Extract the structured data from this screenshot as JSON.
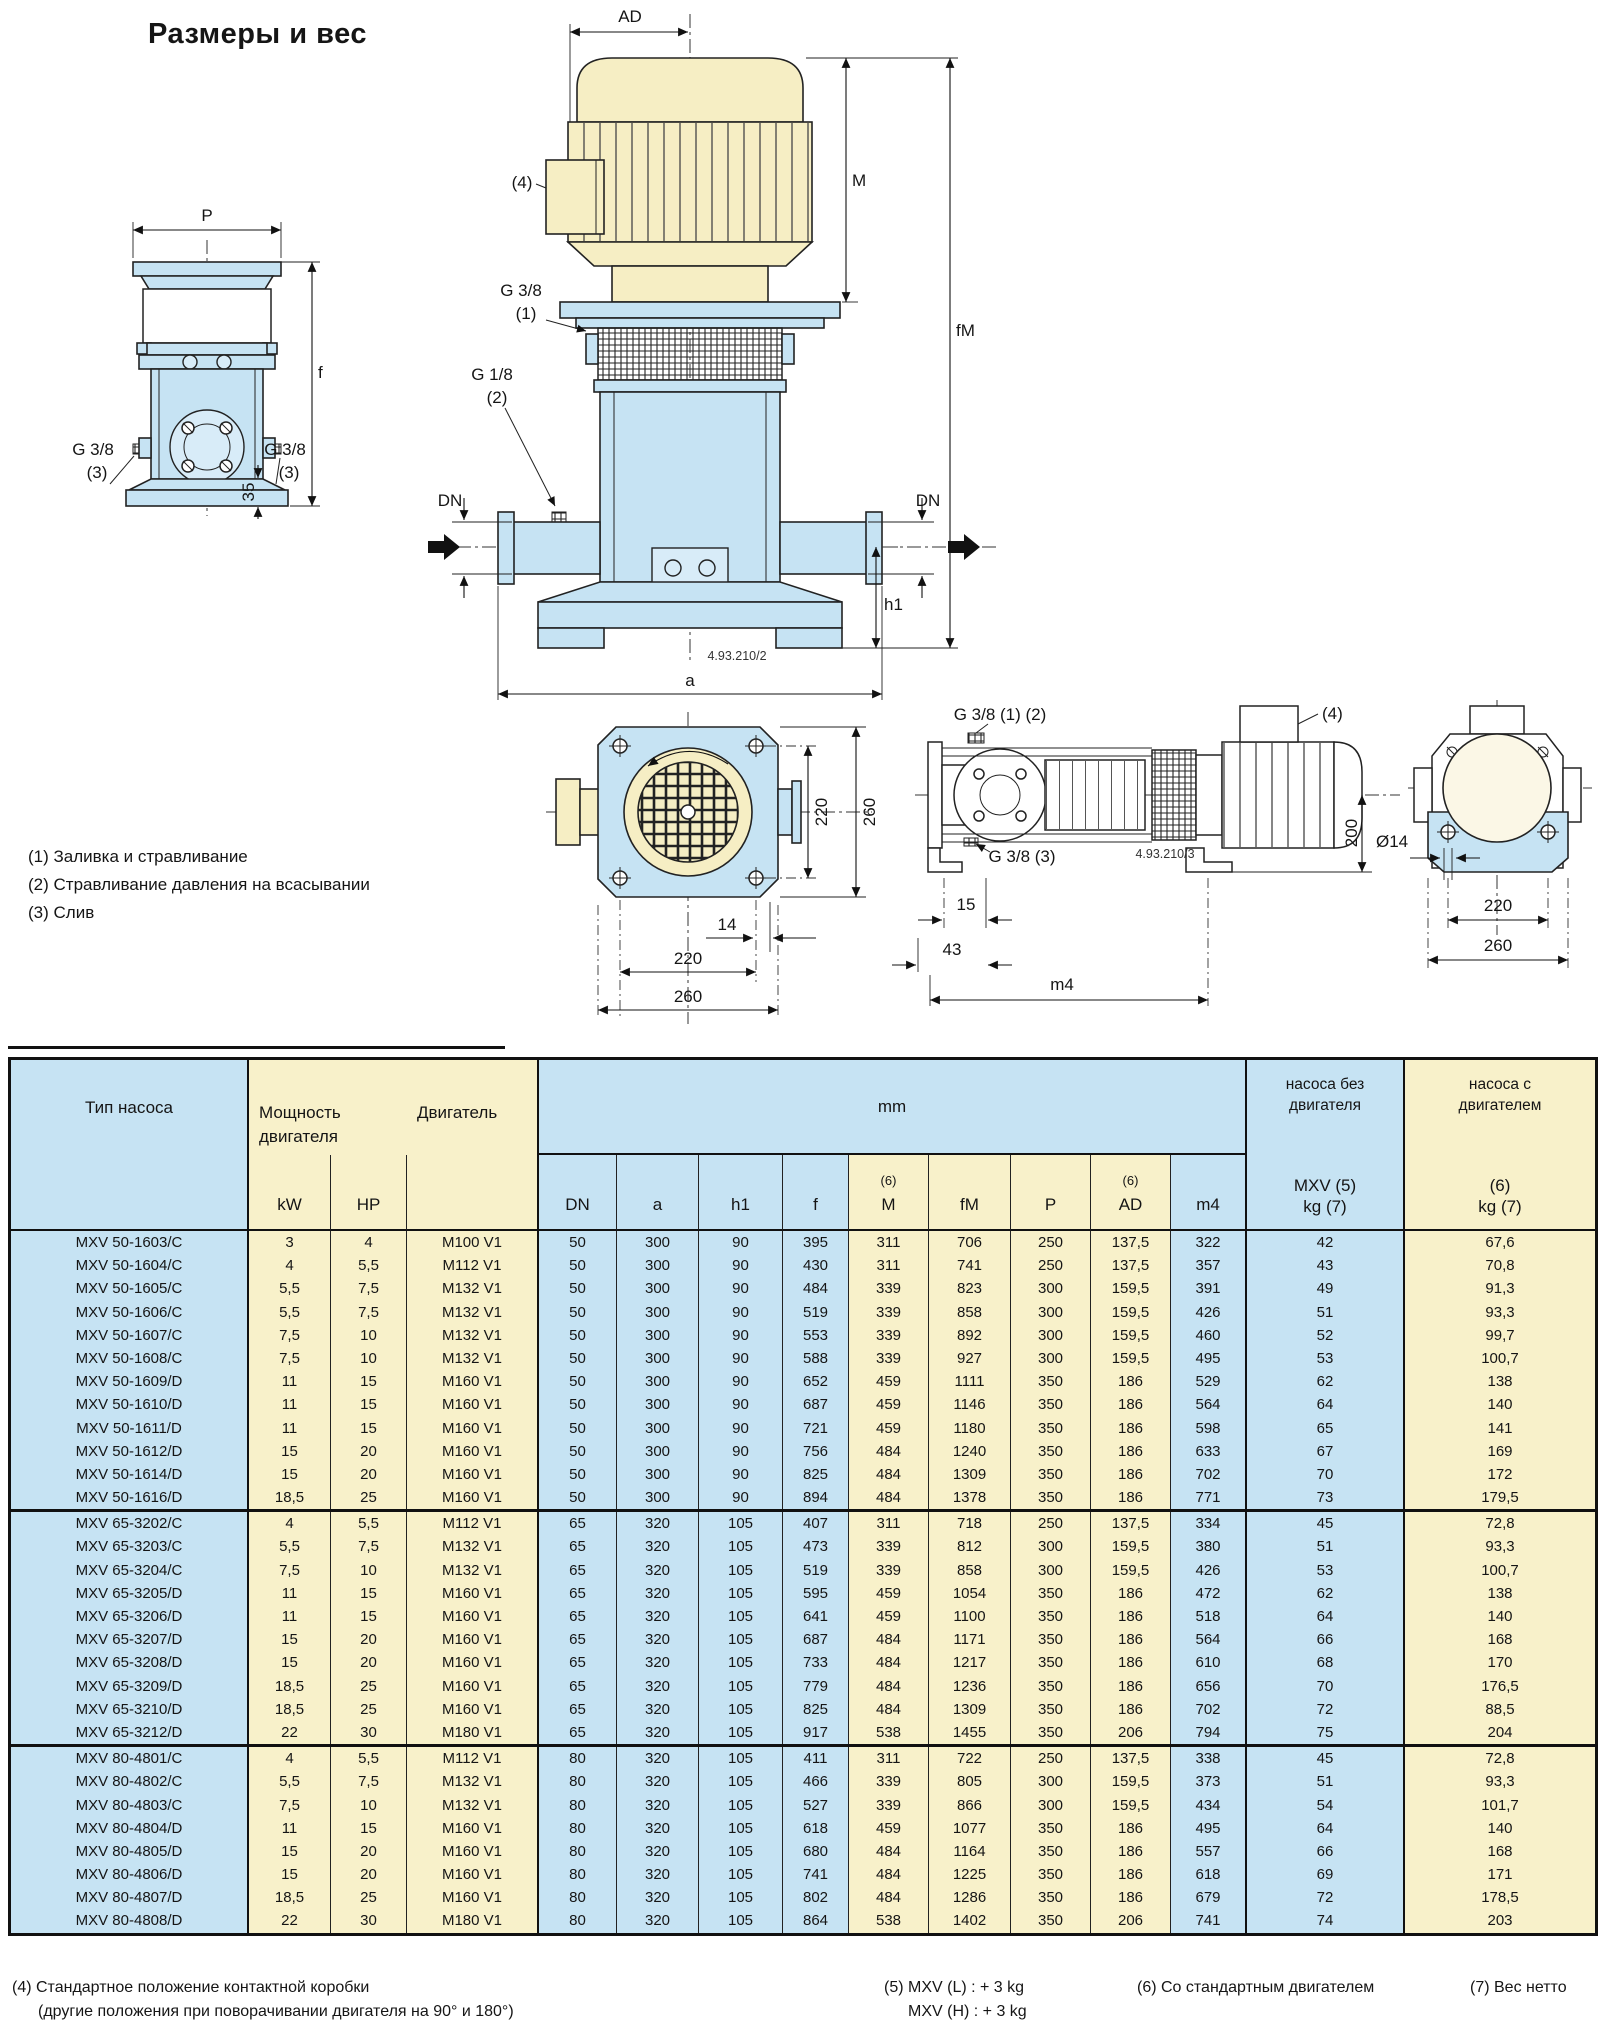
{
  "page": {
    "title": "Размеры и вес"
  },
  "notes": {
    "n1": "(1) Заливка и стравливание",
    "n2": "(2) Стравливание давления на всасывании",
    "n3": "(3) Слив"
  },
  "diagram": {
    "labels": {
      "p": "P",
      "f": "f",
      "g38": "G 3/8",
      "n3": "(3)",
      "d35": "35",
      "ad": "AD",
      "n4": "(4)",
      "m": "M",
      "fm": "fM",
      "n1": "(1)",
      "g18": "G 1/8",
      "n2": "(2)",
      "dn": "DN",
      "h1": "h1",
      "a": "a",
      "dwg2": "4.93.210/2",
      "dwg3": "4.93.210/3",
      "g38_12": "G 3/8 (1) (2)",
      "g38_3": "G 3/8 (3)",
      "d14": "14",
      "d15": "15",
      "d43": "43",
      "m4": "m4",
      "d200": "200",
      "dia14": "Ø14",
      "d220": "220",
      "d260": "260"
    }
  },
  "table": {
    "header": {
      "pump_type": "Тип насоса",
      "power_line1": "Мощность",
      "power_line2": "двигателя",
      "motor": "Двигатель",
      "mm": "mm",
      "kw": "kW",
      "hp": "HP",
      "note6": "(6)",
      "cols": {
        "dn": "DN",
        "a": "a",
        "h1": "h1",
        "f": "f",
        "m": "M",
        "fm": "fM",
        "p": "P",
        "ad": "AD",
        "m4": "m4"
      },
      "wo1": "насоса без",
      "wo2": "двигателя",
      "wo3": "MXV (5)",
      "wo4": "kg (7)",
      "w1": "насоса с",
      "w2": "двигателем",
      "w3": "(6)",
      "w4": "kg (7)"
    },
    "groups": [
      {
        "rows": [
          [
            "MXV 50-1603/C",
            "3",
            "4",
            "M100 V1",
            "50",
            "300",
            "90",
            "395",
            "311",
            "706",
            "250",
            "137,5",
            "322",
            "42",
            "67,6"
          ],
          [
            "MXV 50-1604/C",
            "4",
            "5,5",
            "M112 V1",
            "50",
            "300",
            "90",
            "430",
            "311",
            "741",
            "250",
            "137,5",
            "357",
            "43",
            "70,8"
          ],
          [
            "MXV 50-1605/C",
            "5,5",
            "7,5",
            "M132 V1",
            "50",
            "300",
            "90",
            "484",
            "339",
            "823",
            "300",
            "159,5",
            "391",
            "49",
            "91,3"
          ],
          [
            "MXV 50-1606/C",
            "5,5",
            "7,5",
            "M132 V1",
            "50",
            "300",
            "90",
            "519",
            "339",
            "858",
            "300",
            "159,5",
            "426",
            "51",
            "93,3"
          ],
          [
            "MXV 50-1607/C",
            "7,5",
            "10",
            "M132 V1",
            "50",
            "300",
            "90",
            "553",
            "339",
            "892",
            "300",
            "159,5",
            "460",
            "52",
            "99,7"
          ],
          [
            "MXV 50-1608/C",
            "7,5",
            "10",
            "M132 V1",
            "50",
            "300",
            "90",
            "588",
            "339",
            "927",
            "300",
            "159,5",
            "495",
            "53",
            "100,7"
          ],
          [
            "MXV 50-1609/D",
            "11",
            "15",
            "M160 V1",
            "50",
            "300",
            "90",
            "652",
            "459",
            "1111",
            "350",
            "186",
            "529",
            "62",
            "138"
          ],
          [
            "MXV 50-1610/D",
            "11",
            "15",
            "M160 V1",
            "50",
            "300",
            "90",
            "687",
            "459",
            "1146",
            "350",
            "186",
            "564",
            "64",
            "140"
          ],
          [
            "MXV 50-1611/D",
            "11",
            "15",
            "M160 V1",
            "50",
            "300",
            "90",
            "721",
            "459",
            "1180",
            "350",
            "186",
            "598",
            "65",
            "141"
          ],
          [
            "MXV 50-1612/D",
            "15",
            "20",
            "M160 V1",
            "50",
            "300",
            "90",
            "756",
            "484",
            "1240",
            "350",
            "186",
            "633",
            "67",
            "169"
          ],
          [
            "MXV 50-1614/D",
            "15",
            "20",
            "M160 V1",
            "50",
            "300",
            "90",
            "825",
            "484",
            "1309",
            "350",
            "186",
            "702",
            "70",
            "172"
          ],
          [
            "MXV 50-1616/D",
            "18,5",
            "25",
            "M160 V1",
            "50",
            "300",
            "90",
            "894",
            "484",
            "1378",
            "350",
            "186",
            "771",
            "73",
            "179,5"
          ]
        ]
      },
      {
        "rows": [
          [
            "MXV 65-3202/C",
            "4",
            "5,5",
            "M112 V1",
            "65",
            "320",
            "105",
            "407",
            "311",
            "718",
            "250",
            "137,5",
            "334",
            "45",
            "72,8"
          ],
          [
            "MXV 65-3203/C",
            "5,5",
            "7,5",
            "M132 V1",
            "65",
            "320",
            "105",
            "473",
            "339",
            "812",
            "300",
            "159,5",
            "380",
            "51",
            "93,3"
          ],
          [
            "MXV 65-3204/C",
            "7,5",
            "10",
            "M132 V1",
            "65",
            "320",
            "105",
            "519",
            "339",
            "858",
            "300",
            "159,5",
            "426",
            "53",
            "100,7"
          ],
          [
            "MXV 65-3205/D",
            "11",
            "15",
            "M160 V1",
            "65",
            "320",
            "105",
            "595",
            "459",
            "1054",
            "350",
            "186",
            "472",
            "62",
            "138"
          ],
          [
            "MXV 65-3206/D",
            "11",
            "15",
            "M160 V1",
            "65",
            "320",
            "105",
            "641",
            "459",
            "1100",
            "350",
            "186",
            "518",
            "64",
            "140"
          ],
          [
            "MXV 65-3207/D",
            "15",
            "20",
            "M160 V1",
            "65",
            "320",
            "105",
            "687",
            "484",
            "1171",
            "350",
            "186",
            "564",
            "66",
            "168"
          ],
          [
            "MXV 65-3208/D",
            "15",
            "20",
            "M160 V1",
            "65",
            "320",
            "105",
            "733",
            "484",
            "1217",
            "350",
            "186",
            "610",
            "68",
            "170"
          ],
          [
            "MXV 65-3209/D",
            "18,5",
            "25",
            "M160 V1",
            "65",
            "320",
            "105",
            "779",
            "484",
            "1236",
            "350",
            "186",
            "656",
            "70",
            "176,5"
          ],
          [
            "MXV 65-3210/D",
            "18,5",
            "25",
            "M160 V1",
            "65",
            "320",
            "105",
            "825",
            "484",
            "1309",
            "350",
            "186",
            "702",
            "72",
            "88,5"
          ],
          [
            "MXV 65-3212/D",
            "22",
            "30",
            "M180 V1",
            "65",
            "320",
            "105",
            "917",
            "538",
            "1455",
            "350",
            "206",
            "794",
            "75",
            "204"
          ]
        ]
      },
      {
        "rows": [
          [
            "MXV 80-4801/C",
            "4",
            "5,5",
            "M112 V1",
            "80",
            "320",
            "105",
            "411",
            "311",
            "722",
            "250",
            "137,5",
            "338",
            "45",
            "72,8"
          ],
          [
            "MXV 80-4802/C",
            "5,5",
            "7,5",
            "M132 V1",
            "80",
            "320",
            "105",
            "466",
            "339",
            "805",
            "300",
            "159,5",
            "373",
            "51",
            "93,3"
          ],
          [
            "MXV 80-4803/C",
            "7,5",
            "10",
            "M132 V1",
            "80",
            "320",
            "105",
            "527",
            "339",
            "866",
            "300",
            "159,5",
            "434",
            "54",
            "101,7"
          ],
          [
            "MXV 80-4804/D",
            "11",
            "15",
            "M160 V1",
            "80",
            "320",
            "105",
            "618",
            "459",
            "1077",
            "350",
            "186",
            "495",
            "64",
            "140"
          ],
          [
            "MXV 80-4805/D",
            "15",
            "20",
            "M160 V1",
            "80",
            "320",
            "105",
            "680",
            "484",
            "1164",
            "350",
            "186",
            "557",
            "66",
            "168"
          ],
          [
            "MXV 80-4806/D",
            "15",
            "20",
            "M160 V1",
            "80",
            "320",
            "105",
            "741",
            "484",
            "1225",
            "350",
            "186",
            "618",
            "69",
            "171"
          ],
          [
            "MXV 80-4807/D",
            "18,5",
            "25",
            "M160 V1",
            "80",
            "320",
            "105",
            "802",
            "484",
            "1286",
            "350",
            "186",
            "679",
            "72",
            "178,5"
          ],
          [
            "MXV 80-4808/D",
            "22",
            "30",
            "M180 V1",
            "80",
            "320",
            "105",
            "864",
            "538",
            "1402",
            "350",
            "206",
            "741",
            "74",
            "203"
          ]
        ]
      }
    ]
  },
  "footnotes": {
    "f4a": "(4) Стандартное положение контактной коробки",
    "f4b": "(другие положения при поворачивании двигателя на 90° и 180°)",
    "f5a": "(5) MXV (L) : + 3 kg",
    "f5b": "MXV (H) : + 3 kg",
    "f6": "(6) Со стандартным двигателем",
    "f7": "(7) Вес нетто"
  }
}
